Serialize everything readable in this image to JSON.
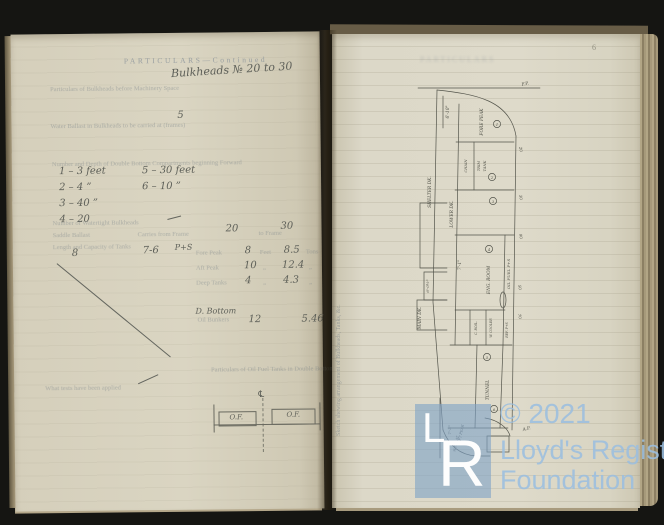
{
  "page_number": "6",
  "watermark": {
    "copyright": "© 2021",
    "org_line1": "Lloyd's Register",
    "org_line2": "Foundation",
    "logo_l": "L",
    "logo_r": "R",
    "logo_color": "#7da1c7",
    "text_color": "#9bbedf"
  },
  "left_page": {
    "header": "PARTICULARS—Continued",
    "handwritten": {
      "bulkheads_note": "Bulkheads № 20 to 30",
      "count": "5",
      "compartments": [
        "1 –  3 feet",
        "2 –   4   ”",
        "3 –   40  ”",
        "4 –   20"
      ],
      "compartments2": [
        "5 – 30 feet",
        "6 – 10  ”"
      ],
      "from_frame": "20",
      "to_frame": "30",
      "tank_no": "8",
      "tank_dim": "7-6",
      "tank_side": "P+S",
      "db_label": "D. Bottom",
      "of_left": "O.F.",
      "of_right": "O.F.",
      "centerline": "℄"
    },
    "printed": {
      "bulkheads_label": "Particulars of Bulkheads before Machinery Space",
      "ballast_label": "Water Ballast in Bulkheads to be carried at (frames)",
      "compartments_label": "Number and Depth of Double Bottom Compartments beginning Forward",
      "watertight_label": "Number of Watertight Bulkheads",
      "saddle_label": "Saddle Ballast",
      "carries_label": "Carries from Frame",
      "to_frame_label": "to Frame",
      "tanks_label": "Length and Capacity of Tanks",
      "oil_fuel_label": "Particulars of Oil Fuel Tanks in Double Bottom",
      "tests_label": "What tests have been applied",
      "feet": "Feet",
      "tons": "Tons",
      "ditto": "„"
    },
    "tank_table": {
      "rows": [
        {
          "label": "Fore Peak",
          "feet": "8",
          "tons": "8.5"
        },
        {
          "label": "Aft Peak",
          "feet": "10",
          "tons": "12.4"
        },
        {
          "label": "Deep Tanks",
          "feet": "4",
          "tons": "4.3"
        },
        {
          "label": "Oil Bunkers",
          "feet": "12",
          "tons": "5.46"
        }
      ]
    }
  },
  "right_page": {
    "margin_caption": "Sketch shewing arrangement of Bulkheads, Tanks, &c.",
    "ghost_heading": "PARTICULARS",
    "drawing": {
      "fp": "F.P.",
      "ap": "A.P.",
      "dim_bow": "6'-10\"",
      "fore_peak": "Fore Peak",
      "chain": "Chain",
      "trim": "Trim",
      "tank": "Tank",
      "shelter_dk": "Shelter Dk.",
      "lower_dk": "Lower Dk.",
      "main_dk": "Main Dk.",
      "oil_fuel": "Oil Fuel P+S",
      "eng_room": "Eng. Room",
      "cboil": "C. Boil.",
      "wcooler": "W. Cooler",
      "ref": "Ref. P+S",
      "tunnel": "Tunnel",
      "aft_peak": "Aft Peak",
      "wt_flat": "W.T. Flat",
      "dim_eng": "7'-1\"",
      "dim_main": "6'-0½\"",
      "dim_aft": "7'-3\"",
      "f20": "20",
      "f30": "30",
      "f90": "90",
      "f50": "50",
      "f70": "70",
      "c1": "1",
      "c2": "2",
      "c3": "3",
      "c4": "4",
      "c5": "5",
      "c6": "6"
    }
  }
}
